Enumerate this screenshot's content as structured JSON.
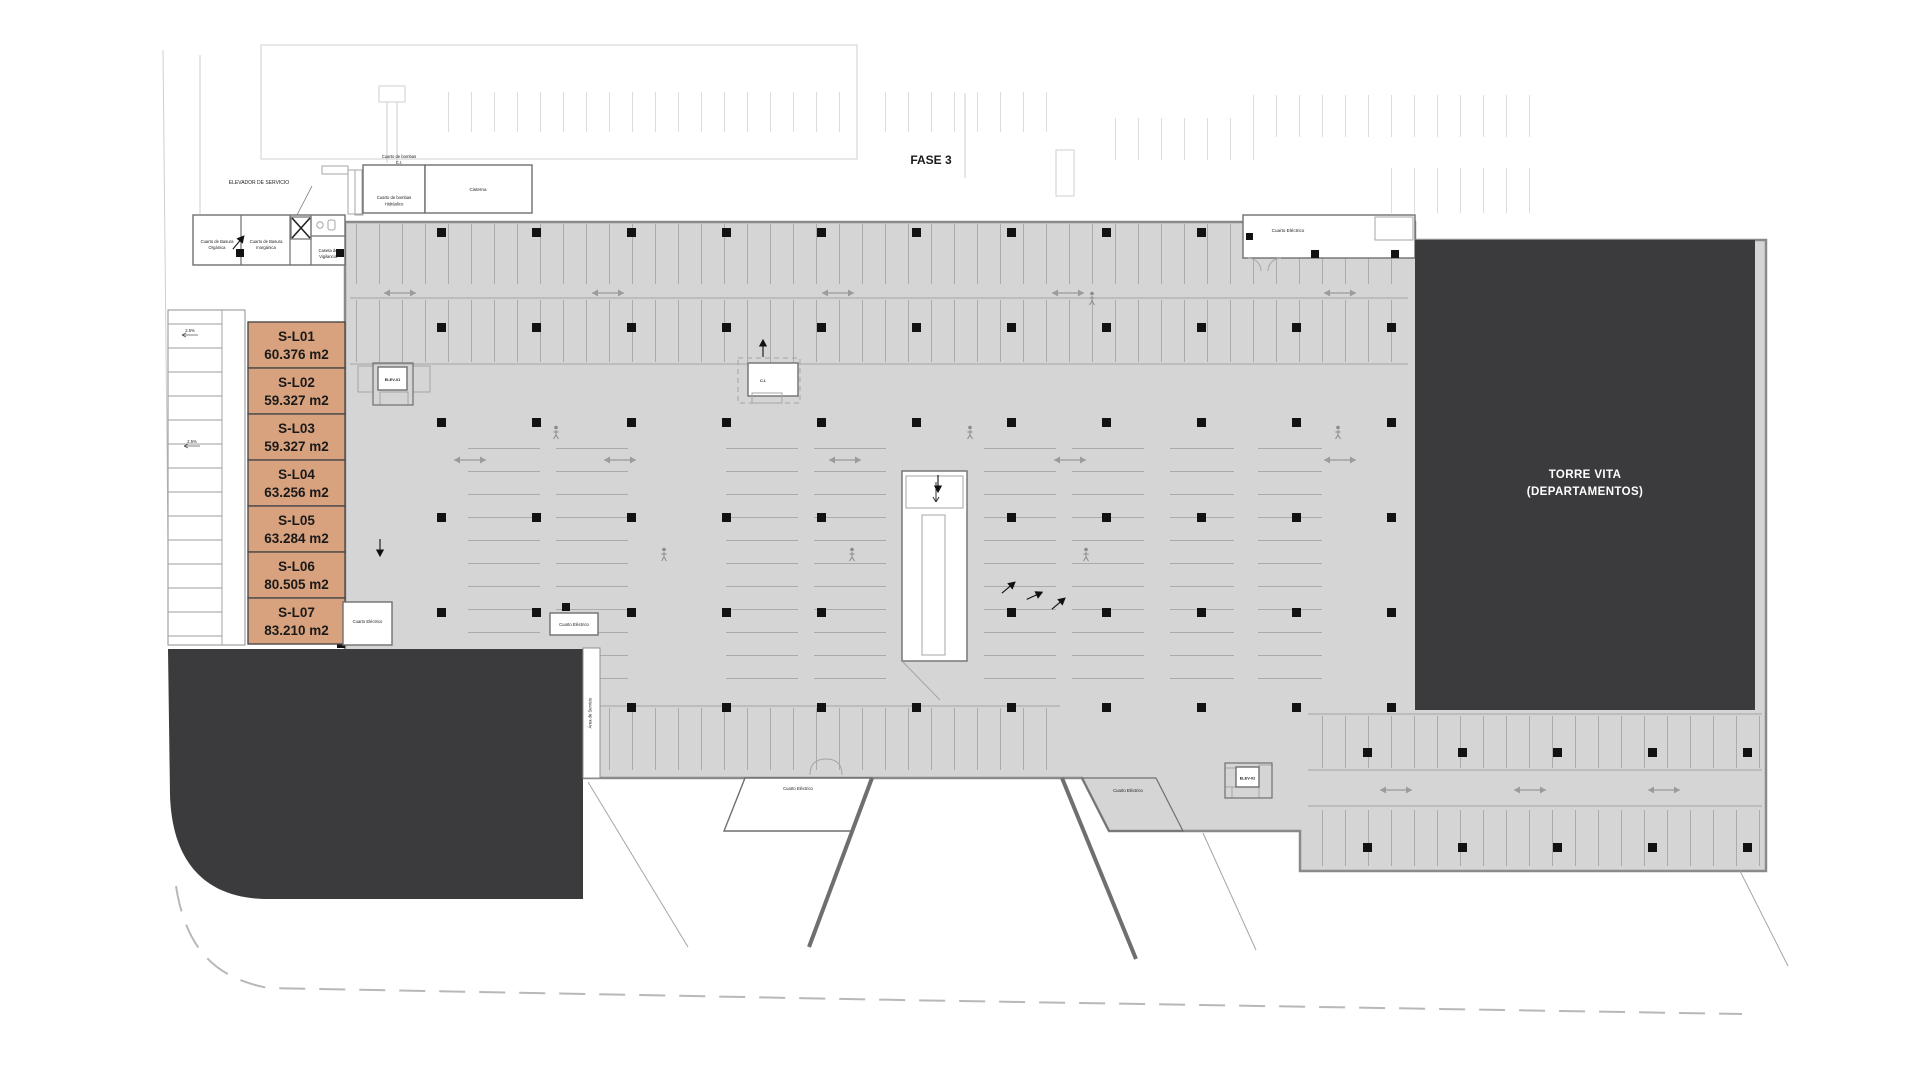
{
  "plan": {
    "phase_label": "FASE 3",
    "tower": [
      "TORRE VITA",
      "(DEPARTAMENTOS)"
    ]
  },
  "storage_units": [
    {
      "id": "S-L01",
      "area": "60.376 m2"
    },
    {
      "id": "S-L02",
      "area": "59.327 m2"
    },
    {
      "id": "S-L03",
      "area": "59.327 m2"
    },
    {
      "id": "S-L04",
      "area": "63.256 m2"
    },
    {
      "id": "S-L05",
      "area": "63.284 m2"
    },
    {
      "id": "S-L06",
      "area": "80.505 m2"
    },
    {
      "id": "S-L07",
      "area": "83.210 m2"
    }
  ],
  "rooms": {
    "service_elevator": "ELEVADOR DE SERVICIO",
    "trash_organic": [
      "Cuarto de Basura",
      "Orgánica"
    ],
    "trash_inorganic": [
      "Cuarto de Basura",
      "Inorgánica"
    ],
    "guard_booth": [
      "Caseta de",
      "Vigilancia"
    ],
    "pump_room_fire": [
      "Cuarto de bombas",
      "C.I."
    ],
    "pump_room_hydraulic": [
      "Cuarto de bombas",
      "Hidráulico"
    ],
    "cistern": "Cisterna",
    "electrical_room": "Cuarto Eléctrico",
    "service_area": "Área de Servicio",
    "elevator_1": "ELEV-01",
    "elevator_2": "ELEV-02",
    "core_center": "C.I."
  },
  "annotations": {
    "slope_1": "2.5%",
    "slope_2": "2.5%"
  },
  "colors": {
    "paper": "#ffffff",
    "slab": "#d5d5d5",
    "slab-line": "#8a8a8a",
    "dark-block": "#3b3b3d",
    "unit-fill": "#d9a27e",
    "unit-border": "#4a4a4a",
    "wall": "#6f6f6f",
    "tick": "#ababab",
    "ghost": "#dcdcdc",
    "text-dark": "#1a1a1a",
    "text-light": "#ffffff",
    "arrow": "#9b9b9b",
    "dash": "#b8b8b8"
  }
}
